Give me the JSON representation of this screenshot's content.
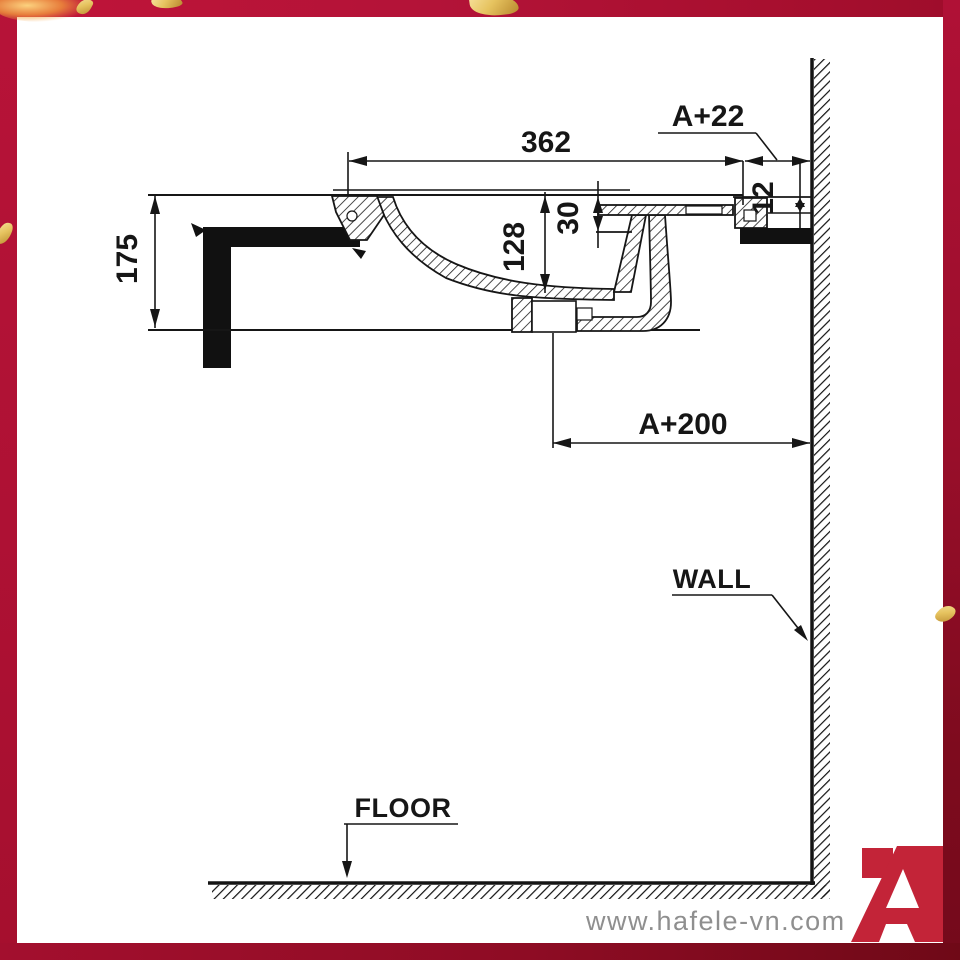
{
  "frame": {
    "border_color_top": "#b31338",
    "border_color_left": "#ae1134",
    "border_color_right_bottom": "#740a1b",
    "border_color_bottom_right": "#6f0917",
    "confetti_color": "#e6c35f"
  },
  "drawing": {
    "ink": "#161616",
    "dims": {
      "basin_width": "362",
      "overhang_to_wall": "A+22",
      "rim_edge": "12",
      "overflow_depth": "30",
      "bowl_depth": "128",
      "front_height": "175",
      "drain_to_wall": "A+200"
    },
    "labels": {
      "wall": "WALL",
      "floor": "FLOOR"
    }
  },
  "footer": {
    "website": "www.hafele-vn.com",
    "logo_color": "#c32438"
  }
}
